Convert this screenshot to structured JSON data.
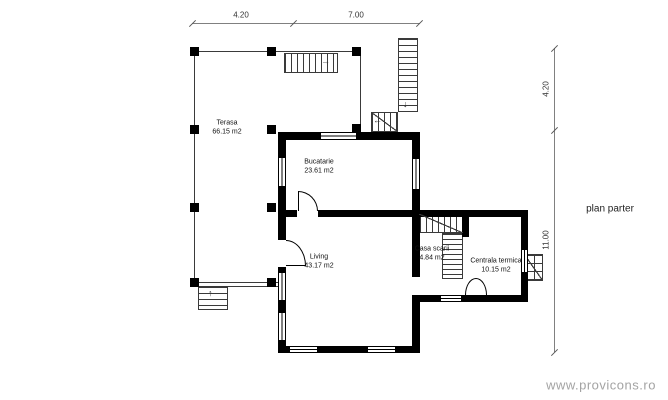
{
  "plan": {
    "title": "plan parter",
    "watermark": "www.provicons.ro"
  },
  "rooms": {
    "terasa": {
      "name": "Terasa",
      "area": "66.15 m2"
    },
    "bucatarie": {
      "name": "Bucatarie",
      "area": "23.61 m2"
    },
    "living": {
      "name": "Living",
      "area": "43.17 m2"
    },
    "casa_scarii": {
      "name": "Casa scarii",
      "area": "4.84 m2"
    },
    "centrala": {
      "name": "Centrala termica",
      "area": "10.15 m2"
    }
  },
  "dimensions": {
    "top": [
      "4.20",
      "7.00"
    ],
    "right": [
      "4.20",
      "11.00"
    ]
  },
  "icons": {
    "arrow_up": "↑",
    "arrow_down": "↓",
    "arrow_left": "←",
    "arrow_right": "→"
  },
  "colors": {
    "wall": "#000000",
    "thin_line": "#3a3a3a",
    "dimension_line": "#808080",
    "label_text": "#111111",
    "watermark_text": "#a3a3a3",
    "background": "#ffffff"
  }
}
